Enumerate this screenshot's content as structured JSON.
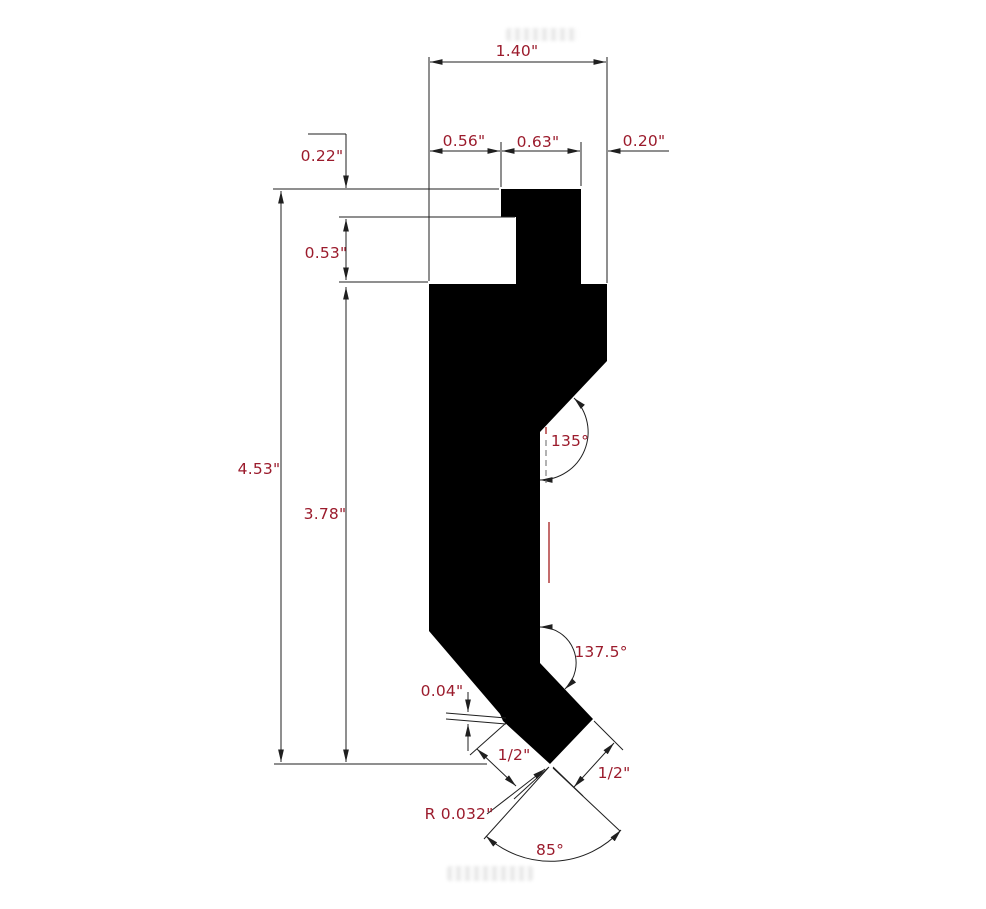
{
  "drawing": {
    "type": "technical-dimension-drawing",
    "subject": "press-brake punch tool cross-section",
    "colors": {
      "background": "#ffffff",
      "line": "#1f1f1f",
      "text": "#9b1b2c",
      "accent_red": "#b03a3a",
      "shape_fill": "#8a0016",
      "shape_outline": "#000000"
    },
    "shape": {
      "name": "punch-profile-polygon",
      "points": "501,189 581,189 581,284 607,284 607,361 540,432 540,663 593,719 550,764 503,721 500,714 429,631 429,284 516,284 516,217 501,217"
    },
    "labels": {
      "total_width": "1.40\"",
      "tang_left_offset": "0.56\"",
      "tang_width": "0.63\"",
      "tang_right_offset": "0.20\"",
      "top_step_height": "0.22\"",
      "neck_height": "0.53\"",
      "overall_height": "4.53\"",
      "body_height": "3.78\"",
      "upper_relief_angle": "135°",
      "lower_relief_angle": "137.5°",
      "shoulder_step": "0.04\"",
      "left_tip_face": "1/2\"",
      "right_tip_face": "1/2\"",
      "tip_radius": "R 0.032\"",
      "tip_included_angle": "85°"
    }
  }
}
